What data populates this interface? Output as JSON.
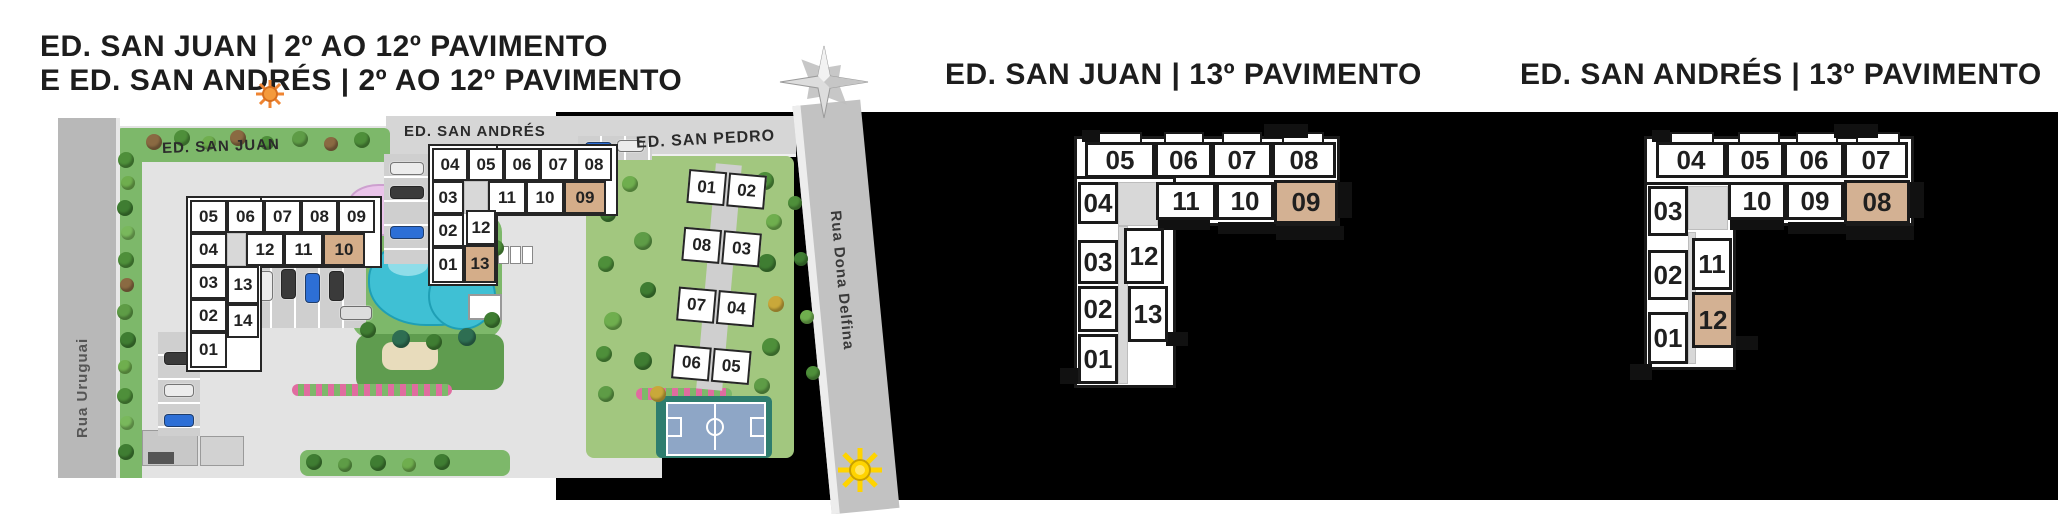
{
  "titles": {
    "left_line1": "ED. SAN JUAN | 2º AO 12º PAVIMENTO",
    "left_line2": "E ED. SAN ANDRÉS | 2º AO 12º PAVIMENTO"
  },
  "site": {
    "street_left": "Rua Uruguai",
    "street_right": "Rua Dona Delfina",
    "labels": {
      "san_juan": "ED. SAN JUAN",
      "san_andres": "ED. SAN ANDRÉS",
      "san_pedro": "ED. SAN PEDRO"
    },
    "backdrops": [
      {
        "x": 186,
        "y": 196,
        "w": 196,
        "h": 72
      },
      {
        "x": 186,
        "y": 196,
        "w": 76,
        "h": 176
      },
      {
        "x": 428,
        "y": 144,
        "w": 190,
        "h": 72
      },
      {
        "x": 428,
        "y": 144,
        "w": 70,
        "h": 142
      }
    ],
    "corridors": [
      {
        "x": 227,
        "y": 233,
        "w": 19,
        "h": 33
      },
      {
        "x": 246,
        "y": 266,
        "w": 10,
        "h": 72
      },
      {
        "x": 464,
        "y": 181,
        "w": 24,
        "h": 33
      }
    ],
    "san_juan_units": [
      {
        "label": "05",
        "x": 190,
        "y": 200,
        "w": 37,
        "h": 33
      },
      {
        "label": "06",
        "x": 227,
        "y": 200,
        "w": 37,
        "h": 33
      },
      {
        "label": "07",
        "x": 264,
        "y": 200,
        "w": 37,
        "h": 33
      },
      {
        "label": "08",
        "x": 301,
        "y": 200,
        "w": 37,
        "h": 33
      },
      {
        "label": "09",
        "x": 338,
        "y": 200,
        "w": 37,
        "h": 33
      },
      {
        "label": "04",
        "x": 190,
        "y": 233,
        "w": 37,
        "h": 33
      },
      {
        "label": "12",
        "x": 246,
        "y": 233,
        "w": 38,
        "h": 33
      },
      {
        "label": "11",
        "x": 284,
        "y": 233,
        "w": 39,
        "h": 33
      },
      {
        "label": "10",
        "x": 323,
        "y": 233,
        "w": 42,
        "h": 33,
        "hl": true
      },
      {
        "label": "03",
        "x": 190,
        "y": 266,
        "w": 37,
        "h": 33
      },
      {
        "label": "13",
        "x": 227,
        "y": 266,
        "w": 32,
        "h": 38
      },
      {
        "label": "02",
        "x": 190,
        "y": 299,
        "w": 37,
        "h": 33
      },
      {
        "label": "14",
        "x": 227,
        "y": 304,
        "w": 32,
        "h": 34
      },
      {
        "label": "01",
        "x": 190,
        "y": 332,
        "w": 37,
        "h": 36
      }
    ],
    "san_andres_units": [
      {
        "label": "04",
        "x": 432,
        "y": 148,
        "w": 36,
        "h": 33
      },
      {
        "label": "05",
        "x": 468,
        "y": 148,
        "w": 36,
        "h": 33
      },
      {
        "label": "06",
        "x": 504,
        "y": 148,
        "w": 36,
        "h": 33
      },
      {
        "label": "07",
        "x": 540,
        "y": 148,
        "w": 36,
        "h": 33
      },
      {
        "label": "08",
        "x": 576,
        "y": 148,
        "w": 36,
        "h": 33
      },
      {
        "label": "03",
        "x": 432,
        "y": 181,
        "w": 32,
        "h": 33
      },
      {
        "label": "11",
        "x": 488,
        "y": 181,
        "w": 38,
        "h": 33
      },
      {
        "label": "10",
        "x": 526,
        "y": 181,
        "w": 38,
        "h": 33
      },
      {
        "label": "09",
        "x": 564,
        "y": 181,
        "w": 42,
        "h": 33,
        "hl": true
      },
      {
        "label": "02",
        "x": 432,
        "y": 214,
        "w": 32,
        "h": 33
      },
      {
        "label": "12",
        "x": 466,
        "y": 210,
        "w": 30,
        "h": 35
      },
      {
        "label": "01",
        "x": 432,
        "y": 247,
        "w": 32,
        "h": 36
      },
      {
        "label": "13",
        "x": 464,
        "y": 245,
        "w": 32,
        "h": 38,
        "hl": true
      }
    ],
    "san_pedro_units": [
      {
        "label": "01",
        "x": 4,
        "y": 8,
        "w": 38,
        "h": 34
      },
      {
        "label": "02",
        "x": 44,
        "y": 8,
        "w": 38,
        "h": 34
      },
      {
        "label": "08",
        "x": 4,
        "y": 66,
        "w": 38,
        "h": 34
      },
      {
        "label": "03",
        "x": 44,
        "y": 66,
        "w": 38,
        "h": 34
      },
      {
        "label": "07",
        "x": 4,
        "y": 126,
        "w": 38,
        "h": 34
      },
      {
        "label": "04",
        "x": 44,
        "y": 126,
        "w": 38,
        "h": 34
      },
      {
        "label": "06",
        "x": 4,
        "y": 184,
        "w": 38,
        "h": 34
      },
      {
        "label": "05",
        "x": 44,
        "y": 184,
        "w": 38,
        "h": 34
      }
    ],
    "lots": [
      {
        "x": 384,
        "y": 154,
        "w": 46,
        "h": 110,
        "cls": "lot-h"
      },
      {
        "x": 248,
        "y": 258,
        "w": 118,
        "h": 70,
        "cls": "lot-v"
      },
      {
        "x": 158,
        "y": 332,
        "w": 42,
        "h": 104,
        "cls": "lot-h"
      },
      {
        "x": 578,
        "y": 136,
        "w": 74,
        "h": 24,
        "cls": "lot-v"
      }
    ],
    "cars": [
      {
        "x": 390,
        "y": 162,
        "w": 34,
        "h": 13,
        "c": "#ececec"
      },
      {
        "x": 390,
        "y": 186,
        "w": 34,
        "h": 13,
        "c": "#3a3a3a"
      },
      {
        "x": 390,
        "y": 226,
        "w": 34,
        "h": 13,
        "c": "#2d6fd6"
      },
      {
        "x": 258,
        "y": 271,
        "w": 15,
        "h": 30,
        "c": "#ececec"
      },
      {
        "x": 281,
        "y": 269,
        "w": 15,
        "h": 30,
        "c": "#3a3a3a"
      },
      {
        "x": 305,
        "y": 273,
        "w": 15,
        "h": 30,
        "c": "#2d6fd6"
      },
      {
        "x": 329,
        "y": 271,
        "w": 15,
        "h": 30,
        "c": "#3a3a3a"
      },
      {
        "x": 340,
        "y": 306,
        "w": 32,
        "h": 14,
        "c": "#dddddd"
      },
      {
        "x": 164,
        "y": 352,
        "w": 30,
        "h": 13,
        "c": "#3a3a3a"
      },
      {
        "x": 164,
        "y": 384,
        "w": 30,
        "h": 13,
        "c": "#ececec"
      },
      {
        "x": 164,
        "y": 414,
        "w": 30,
        "h": 13,
        "c": "#2d6fd6"
      },
      {
        "x": 585,
        "y": 142,
        "w": 27,
        "h": 12,
        "c": "#2d6fd6"
      },
      {
        "x": 617,
        "y": 140,
        "w": 27,
        "h": 12,
        "c": "#ececec"
      }
    ],
    "trees": [
      {
        "x": 118,
        "y": 152,
        "r": 8,
        "c": "#4e8f3a"
      },
      {
        "x": 121,
        "y": 176,
        "r": 7,
        "c": "#6fae4e"
      },
      {
        "x": 117,
        "y": 200,
        "r": 8,
        "c": "#3f7d32"
      },
      {
        "x": 121,
        "y": 226,
        "r": 7,
        "c": "#79b85c"
      },
      {
        "x": 118,
        "y": 252,
        "r": 8,
        "c": "#4e8f3a"
      },
      {
        "x": 120,
        "y": 278,
        "r": 7,
        "c": "#8a6a42"
      },
      {
        "x": 117,
        "y": 304,
        "r": 8,
        "c": "#5e9c46"
      },
      {
        "x": 120,
        "y": 332,
        "r": 8,
        "c": "#3f7d32"
      },
      {
        "x": 118,
        "y": 360,
        "r": 7,
        "c": "#6fae4e"
      },
      {
        "x": 117,
        "y": 388,
        "r": 8,
        "c": "#4e8f3a"
      },
      {
        "x": 120,
        "y": 416,
        "r": 7,
        "c": "#79b85c"
      },
      {
        "x": 118,
        "y": 444,
        "r": 8,
        "c": "#3f7d32"
      },
      {
        "x": 146,
        "y": 134,
        "r": 8,
        "c": "#8a6a42"
      },
      {
        "x": 174,
        "y": 130,
        "r": 8,
        "c": "#4e8f3a"
      },
      {
        "x": 202,
        "y": 136,
        "r": 7,
        "c": "#6fae4e"
      },
      {
        "x": 230,
        "y": 130,
        "r": 8,
        "c": "#8a6a42"
      },
      {
        "x": 260,
        "y": 136,
        "r": 7,
        "c": "#4e8f3a"
      },
      {
        "x": 292,
        "y": 131,
        "r": 8,
        "c": "#5e9c46"
      },
      {
        "x": 324,
        "y": 137,
        "r": 7,
        "c": "#8a6a42"
      },
      {
        "x": 354,
        "y": 132,
        "r": 8,
        "c": "#4e8f3a"
      },
      {
        "x": 350,
        "y": 210,
        "r": 9,
        "c": "#3f7d32"
      },
      {
        "x": 336,
        "y": 232,
        "r": 8,
        "c": "#2e6e52"
      },
      {
        "x": 360,
        "y": 322,
        "r": 8,
        "c": "#3f7d32"
      },
      {
        "x": 392,
        "y": 330,
        "r": 9,
        "c": "#2e6e52"
      },
      {
        "x": 426,
        "y": 334,
        "r": 8,
        "c": "#3f7d32"
      },
      {
        "x": 458,
        "y": 328,
        "r": 9,
        "c": "#2e6e52"
      },
      {
        "x": 484,
        "y": 312,
        "r": 8,
        "c": "#3f7d32"
      },
      {
        "x": 488,
        "y": 240,
        "r": 8,
        "c": "#4e8f3a"
      },
      {
        "x": 470,
        "y": 218,
        "r": 8,
        "c": "#2e6e52"
      },
      {
        "x": 452,
        "y": 200,
        "r": 7,
        "c": "#3f7d32"
      },
      {
        "x": 596,
        "y": 166,
        "r": 9,
        "c": "#4e8f3a"
      },
      {
        "x": 622,
        "y": 176,
        "r": 8,
        "c": "#6fae4e"
      },
      {
        "x": 600,
        "y": 206,
        "r": 8,
        "c": "#3f7d32"
      },
      {
        "x": 634,
        "y": 232,
        "r": 9,
        "c": "#5e9c46"
      },
      {
        "x": 598,
        "y": 256,
        "r": 8,
        "c": "#4e8f3a"
      },
      {
        "x": 640,
        "y": 282,
        "r": 8,
        "c": "#3f7d32"
      },
      {
        "x": 604,
        "y": 312,
        "r": 9,
        "c": "#6fae4e"
      },
      {
        "x": 596,
        "y": 346,
        "r": 8,
        "c": "#4e8f3a"
      },
      {
        "x": 634,
        "y": 352,
        "r": 9,
        "c": "#3f7d32"
      },
      {
        "x": 650,
        "y": 386,
        "r": 8,
        "c": "#c9a83a"
      },
      {
        "x": 598,
        "y": 386,
        "r": 8,
        "c": "#5e9c46"
      },
      {
        "x": 756,
        "y": 172,
        "r": 9,
        "c": "#4e8f3a"
      },
      {
        "x": 766,
        "y": 214,
        "r": 8,
        "c": "#6fae4e"
      },
      {
        "x": 758,
        "y": 254,
        "r": 9,
        "c": "#3f7d32"
      },
      {
        "x": 768,
        "y": 296,
        "r": 8,
        "c": "#c9a83a"
      },
      {
        "x": 762,
        "y": 338,
        "r": 9,
        "c": "#4e8f3a"
      },
      {
        "x": 754,
        "y": 378,
        "r": 8,
        "c": "#5e9c46"
      },
      {
        "x": 788,
        "y": 196,
        "r": 7,
        "c": "#4e8f3a"
      },
      {
        "x": 794,
        "y": 252,
        "r": 7,
        "c": "#3f7d32"
      },
      {
        "x": 800,
        "y": 310,
        "r": 7,
        "c": "#6fae4e"
      },
      {
        "x": 806,
        "y": 366,
        "r": 7,
        "c": "#4e8f3a"
      },
      {
        "x": 306,
        "y": 454,
        "r": 8,
        "c": "#3f7d32"
      },
      {
        "x": 338,
        "y": 458,
        "r": 7,
        "c": "#5e9c46"
      },
      {
        "x": 370,
        "y": 455,
        "r": 8,
        "c": "#3f7d32"
      },
      {
        "x": 402,
        "y": 458,
        "r": 7,
        "c": "#6fae4e"
      },
      {
        "x": 434,
        "y": 454,
        "r": 8,
        "c": "#3f7d32"
      }
    ]
  },
  "plans": [
    {
      "title": "ED. SAN JUAN | 13º PAVIMENTO",
      "backdrops": [
        {
          "x": 1074,
          "y": 136,
          "w": 266,
          "h": 90
        },
        {
          "x": 1074,
          "y": 176,
          "w": 102,
          "h": 212
        }
      ],
      "corridors": [
        {
          "x": 1118,
          "y": 182,
          "w": 40,
          "h": 44
        },
        {
          "x": 1118,
          "y": 226,
          "w": 10,
          "h": 158
        }
      ],
      "units": [
        {
          "label": "05",
          "x": 1085,
          "y": 142,
          "w": 70,
          "h": 36
        },
        {
          "label": "06",
          "x": 1155,
          "y": 142,
          "w": 57,
          "h": 36
        },
        {
          "label": "07",
          "x": 1212,
          "y": 142,
          "w": 60,
          "h": 36
        },
        {
          "label": "08",
          "x": 1272,
          "y": 142,
          "w": 64,
          "h": 36
        },
        {
          "label": "04",
          "x": 1078,
          "y": 182,
          "w": 40,
          "h": 42
        },
        {
          "label": "11",
          "x": 1156,
          "y": 182,
          "w": 60,
          "h": 38
        },
        {
          "label": "10",
          "x": 1216,
          "y": 182,
          "w": 58,
          "h": 38
        },
        {
          "label": "09",
          "x": 1274,
          "y": 180,
          "w": 64,
          "h": 44,
          "hl": true
        },
        {
          "label": "03",
          "x": 1078,
          "y": 240,
          "w": 40,
          "h": 44
        },
        {
          "label": "12",
          "x": 1124,
          "y": 228,
          "w": 40,
          "h": 56
        },
        {
          "label": "02",
          "x": 1078,
          "y": 286,
          "w": 40,
          "h": 46
        },
        {
          "label": "13",
          "x": 1128,
          "y": 286,
          "w": 40,
          "h": 56
        },
        {
          "label": "01",
          "x": 1078,
          "y": 334,
          "w": 40,
          "h": 50
        }
      ],
      "balconies": [
        {
          "x": 1098,
          "y": 132,
          "w": 44,
          "h": 10
        },
        {
          "x": 1164,
          "y": 132,
          "w": 40,
          "h": 10
        },
        {
          "x": 1222,
          "y": 132,
          "w": 40,
          "h": 10
        },
        {
          "x": 1282,
          "y": 132,
          "w": 42,
          "h": 10
        }
      ],
      "walls": [
        {
          "x": 1338,
          "y": 182,
          "w": 14,
          "h": 36
        },
        {
          "x": 1158,
          "y": 220,
          "w": 52,
          "h": 10
        },
        {
          "x": 1218,
          "y": 222,
          "w": 58,
          "h": 12
        },
        {
          "x": 1276,
          "y": 226,
          "w": 68,
          "h": 14
        },
        {
          "x": 1082,
          "y": 130,
          "w": 18,
          "h": 12
        },
        {
          "x": 1264,
          "y": 124,
          "w": 44,
          "h": 14
        },
        {
          "x": 1166,
          "y": 332,
          "w": 22,
          "h": 14
        },
        {
          "x": 1060,
          "y": 368,
          "w": 22,
          "h": 16
        }
      ]
    },
    {
      "title": "ED. SAN ANDRÉS | 13º PAVIMENTO",
      "backdrops": [
        {
          "x": 1644,
          "y": 136,
          "w": 270,
          "h": 90
        },
        {
          "x": 1644,
          "y": 182,
          "w": 92,
          "h": 188
        }
      ],
      "corridors": [
        {
          "x": 1688,
          "y": 186,
          "w": 40,
          "h": 44
        },
        {
          "x": 1688,
          "y": 232,
          "w": 8,
          "h": 132
        }
      ],
      "units": [
        {
          "label": "04",
          "x": 1656,
          "y": 142,
          "w": 70,
          "h": 36
        },
        {
          "label": "05",
          "x": 1726,
          "y": 142,
          "w": 58,
          "h": 36
        },
        {
          "label": "06",
          "x": 1784,
          "y": 142,
          "w": 60,
          "h": 36
        },
        {
          "label": "07",
          "x": 1844,
          "y": 142,
          "w": 64,
          "h": 36
        },
        {
          "label": "03",
          "x": 1648,
          "y": 186,
          "w": 40,
          "h": 50
        },
        {
          "label": "10",
          "x": 1728,
          "y": 182,
          "w": 58,
          "h": 38
        },
        {
          "label": "09",
          "x": 1786,
          "y": 182,
          "w": 58,
          "h": 38
        },
        {
          "label": "08",
          "x": 1844,
          "y": 180,
          "w": 66,
          "h": 44,
          "hl": true
        },
        {
          "label": "02",
          "x": 1648,
          "y": 250,
          "w": 40,
          "h": 50
        },
        {
          "label": "11",
          "x": 1692,
          "y": 238,
          "w": 40,
          "h": 52
        },
        {
          "label": "01",
          "x": 1648,
          "y": 312,
          "w": 40,
          "h": 52
        },
        {
          "label": "12",
          "x": 1692,
          "y": 292,
          "w": 42,
          "h": 56,
          "hl": true
        }
      ],
      "balconies": [
        {
          "x": 1670,
          "y": 132,
          "w": 44,
          "h": 10
        },
        {
          "x": 1738,
          "y": 132,
          "w": 42,
          "h": 10
        },
        {
          "x": 1796,
          "y": 132,
          "w": 42,
          "h": 10
        },
        {
          "x": 1856,
          "y": 132,
          "w": 44,
          "h": 10
        }
      ],
      "walls": [
        {
          "x": 1910,
          "y": 182,
          "w": 14,
          "h": 36
        },
        {
          "x": 1730,
          "y": 220,
          "w": 54,
          "h": 10
        },
        {
          "x": 1788,
          "y": 222,
          "w": 58,
          "h": 12
        },
        {
          "x": 1846,
          "y": 226,
          "w": 68,
          "h": 14
        },
        {
          "x": 1652,
          "y": 130,
          "w": 18,
          "h": 12
        },
        {
          "x": 1834,
          "y": 124,
          "w": 44,
          "h": 14
        },
        {
          "x": 1736,
          "y": 336,
          "w": 22,
          "h": 14
        },
        {
          "x": 1630,
          "y": 364,
          "w": 22,
          "h": 16
        }
      ]
    }
  ],
  "icons": {
    "compass": "compass-rose-icon",
    "sun_top": "sun-icon",
    "sun_bottom": "sun-icon"
  },
  "colors": {
    "highlight_tan": "#d3b193",
    "black_panel": "#000000",
    "pool_water": "#3fc0d4",
    "street_gray": "#b8b8b8",
    "garden_green": "#a2c77f"
  }
}
